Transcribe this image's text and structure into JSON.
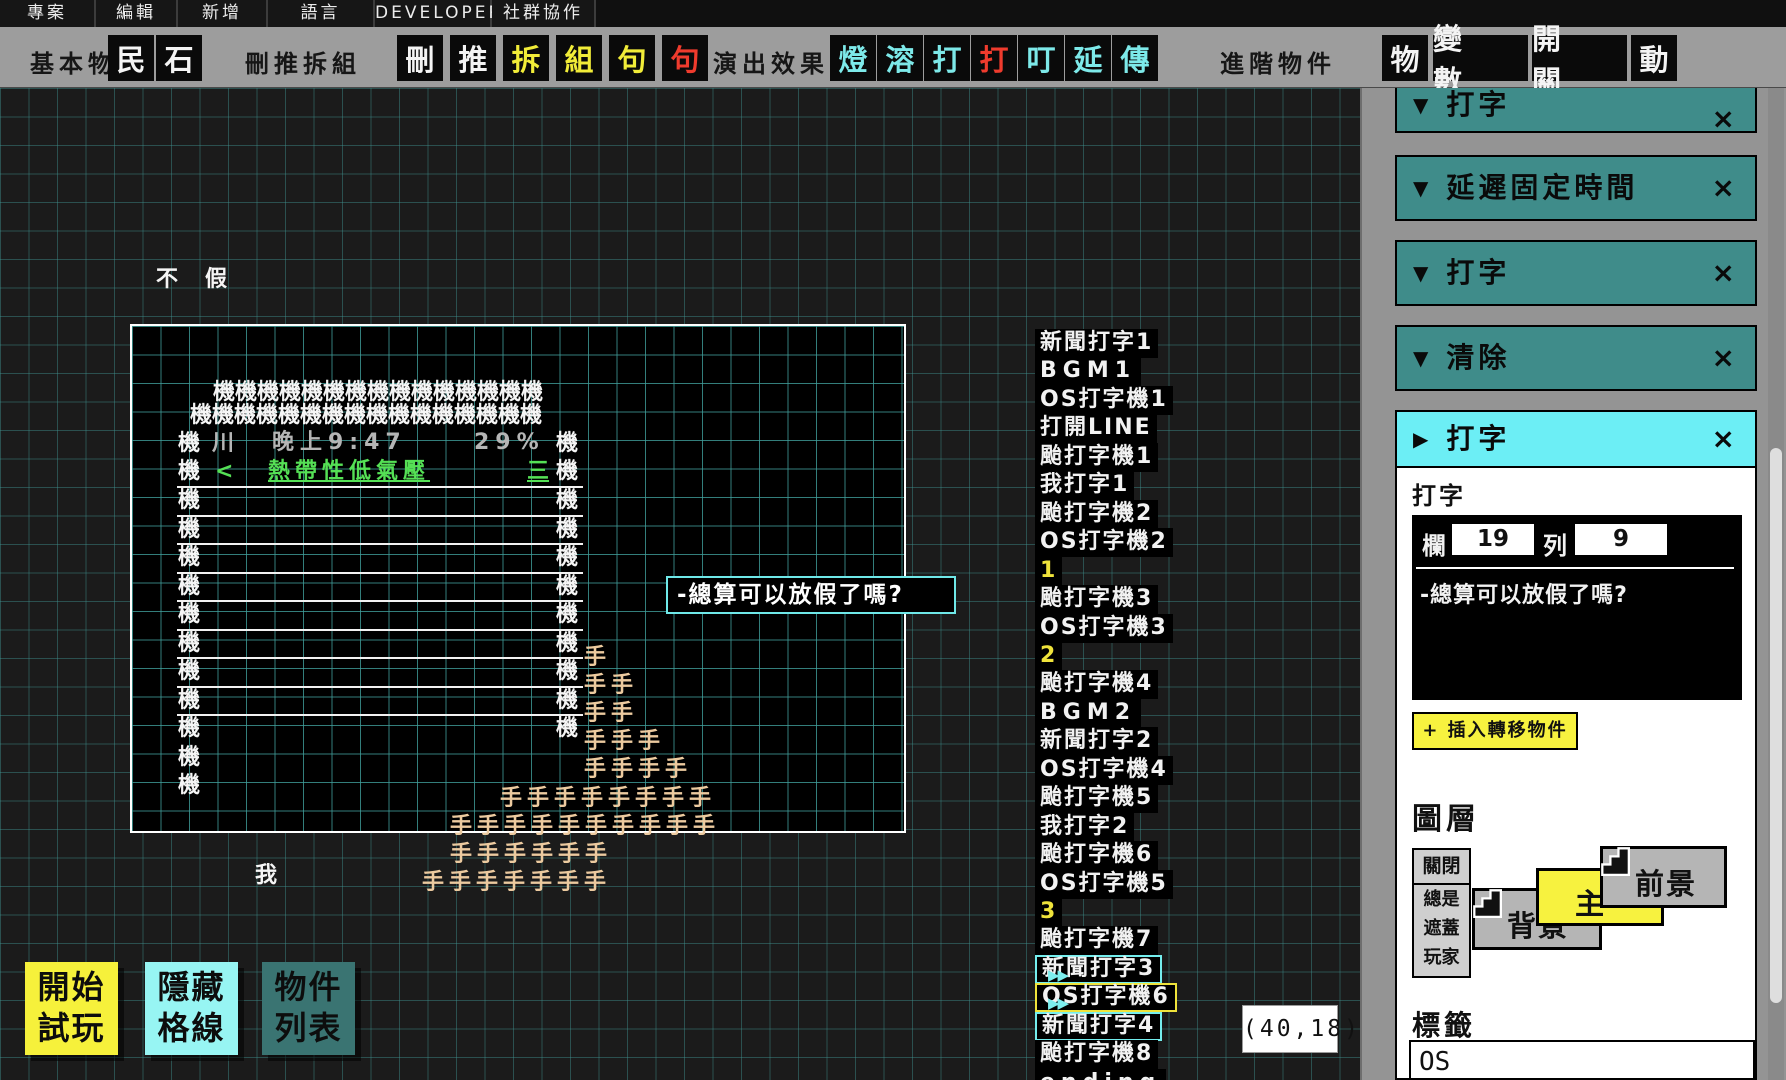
{
  "menu_bar": {
    "items": [
      "專案",
      "編輯",
      "新增",
      "語言",
      "DEVELOPER",
      "社群協作"
    ]
  },
  "toolbar": {
    "groups": [
      {
        "label": "基本物件",
        "buttons": [
          {
            "glyph": "民",
            "color": "white"
          },
          {
            "glyph": "石",
            "color": "white"
          }
        ]
      },
      {
        "label": "刪推拆組",
        "buttons": [
          {
            "glyph": "刪",
            "color": "white"
          },
          {
            "glyph": "推",
            "color": "white"
          },
          {
            "glyph": "拆",
            "color": "yellow"
          },
          {
            "glyph": "組",
            "color": "yellow"
          },
          {
            "glyph": "句",
            "color": "yellow"
          },
          {
            "glyph": "句",
            "color": "red"
          }
        ]
      },
      {
        "label": "演出效果",
        "buttons": [
          {
            "glyph": "燈",
            "color": "cyan"
          },
          {
            "glyph": "溶",
            "color": "cyan"
          },
          {
            "glyph": "打",
            "color": "cyan"
          },
          {
            "glyph": "打",
            "color": "red"
          },
          {
            "glyph": "叮",
            "color": "cyan"
          },
          {
            "glyph": "延",
            "color": "cyan"
          },
          {
            "glyph": "傳",
            "color": "cyan"
          }
        ]
      },
      {
        "label": "進階物件",
        "buttons": [
          {
            "glyph": "物",
            "color": "white"
          },
          {
            "glyph": "變 數",
            "color": "white",
            "wide": true
          },
          {
            "glyph": "開 關",
            "color": "white",
            "wide": true
          },
          {
            "glyph": "動",
            "color": "white"
          }
        ]
      }
    ]
  },
  "canvas": {
    "floating_chars": [
      {
        "x": 156,
        "y": 266,
        "t": "不",
        "c": "w"
      },
      {
        "x": 205,
        "y": 266,
        "t": "假",
        "c": "w"
      },
      {
        "x": 213,
        "y": 379,
        "t": "機機機機機機機機機機機機機機機",
        "c": "w"
      },
      {
        "x": 190,
        "y": 402,
        "t": "機機機機機機機機機機機機機機機機",
        "c": "w"
      },
      {
        "x": 178,
        "y": 430,
        "t": "機",
        "c": "w"
      },
      {
        "x": 212,
        "y": 430,
        "t": "川",
        "c": "g"
      },
      {
        "x": 272,
        "y": 429,
        "t": "晚上9:47",
        "c": "g",
        "ls": 6
      },
      {
        "x": 474,
        "y": 429,
        "t": "29%",
        "c": "g",
        "ls": 6
      },
      {
        "x": 556,
        "y": 430,
        "t": "機",
        "c": "w"
      },
      {
        "x": 178,
        "y": 458,
        "t": "機",
        "c": "w"
      },
      {
        "x": 215,
        "y": 458,
        "t": "<",
        "c": "grn"
      },
      {
        "x": 268,
        "y": 458,
        "t": "熱帶性低氣壓",
        "c": "grn",
        "u": true,
        "ls": 5
      },
      {
        "x": 527,
        "y": 458,
        "t": "三",
        "c": "grn",
        "u": true
      },
      {
        "x": 556,
        "y": 458,
        "t": "機",
        "c": "w"
      },
      {
        "x": 178,
        "y": 487,
        "t": "機\n機\n機\n機\n機\n機\n機\n機\n機\n機\n機",
        "c": "w"
      },
      {
        "x": 556,
        "y": 487,
        "t": "機\n機\n機\n機\n機\n機\n機\n機\n機",
        "c": "w"
      },
      {
        "x": 584,
        "y": 644,
        "t": "手",
        "c": "tan"
      },
      {
        "x": 584,
        "y": 672,
        "t": "手手",
        "c": "tan",
        "ls": 5
      },
      {
        "x": 584,
        "y": 700,
        "t": "手手",
        "c": "tan",
        "ls": 5
      },
      {
        "x": 584,
        "y": 728,
        "t": "手手手",
        "c": "tan",
        "ls": 5
      },
      {
        "x": 584,
        "y": 756,
        "t": "手手手手",
        "c": "tan",
        "ls": 5
      },
      {
        "x": 500,
        "y": 785,
        "t": "手手手手手手手手",
        "c": "tan",
        "ls": 5
      },
      {
        "x": 450,
        "y": 813,
        "t": "手手手手手手手手手手",
        "c": "tan",
        "ls": 5
      },
      {
        "x": 450,
        "y": 841,
        "t": "手手手手手手",
        "c": "tan",
        "ls": 5
      },
      {
        "x": 422,
        "y": 869,
        "t": "手手手手手手手",
        "c": "tan",
        "ls": 5
      },
      {
        "x": 255,
        "y": 862,
        "t": "我",
        "c": "w"
      }
    ],
    "separator_lines": {
      "x": 177,
      "width": 406,
      "ys": [
        486,
        515,
        543,
        572,
        600,
        629,
        657,
        686,
        714
      ]
    },
    "speech_box": {
      "text": "-總算可以放假了嗎?"
    },
    "object_list": [
      {
        "text": "新聞打字1"
      },
      {
        "text": "BGM1",
        "latin": true
      },
      {
        "text": "OS打字機1"
      },
      {
        "text": "打開LINE"
      },
      {
        "text": "颱打字機1"
      },
      {
        "text": "我打字1"
      },
      {
        "text": "颱打字機2"
      },
      {
        "text": "OS打字機2"
      },
      {
        "text": "1",
        "color": "yellow"
      },
      {
        "text": "颱打字機3"
      },
      {
        "text": "OS打字機3"
      },
      {
        "text": "2",
        "color": "yellow"
      },
      {
        "text": "颱打字機4"
      },
      {
        "text": "BGM2",
        "latin": true
      },
      {
        "text": "新聞打字2"
      },
      {
        "text": "OS打字機4"
      },
      {
        "text": "颱打字機5"
      },
      {
        "text": "我打字2"
      },
      {
        "text": "颱打字機6"
      },
      {
        "text": "OS打字機5"
      },
      {
        "text": "3",
        "color": "yellow"
      },
      {
        "text": "颱打字機7"
      },
      {
        "text": "新聞打字3",
        "border": "cyan"
      },
      {
        "text": "OS打字機6",
        "border": "yellow"
      },
      {
        "text": "新聞打字4",
        "border": "cyan"
      },
      {
        "text": "颱打字機8"
      },
      {
        "text": "ending",
        "latin": true
      }
    ],
    "link_arrow_glyph": "▶▶",
    "coords_tooltip": "(40,18)",
    "action_buttons": [
      {
        "label": "開始\n試玩",
        "bg": "#f6f13b"
      },
      {
        "label": "隱藏\n格線",
        "bg": "#97f5f3"
      },
      {
        "label": "物件\n列表",
        "bg": "#3a7472"
      }
    ]
  },
  "sidebar": {
    "collapse_glyph": "▼",
    "expand_glyph": "▶",
    "close_glyph": "×",
    "collapsed_panels": [
      {
        "title": "打字",
        "cut": true
      },
      {
        "title": "延遲固定時間"
      },
      {
        "title": "打字"
      },
      {
        "title": "清除"
      }
    ],
    "active_panel": {
      "title": "打字"
    },
    "typing": {
      "section_label": "打字",
      "column_label": "欄",
      "column_value": "19",
      "row_label": "列",
      "row_value": "9",
      "preview_text": "-總算可以放假了嗎?",
      "insert_button_label": "+ 插入轉移物件"
    },
    "layers": {
      "heading": "圖層",
      "visibility_button": "關閉",
      "cover_button_lines": [
        "總是",
        "遮蓋",
        "玩家"
      ],
      "cards": [
        {
          "label": "背景",
          "type": "gray"
        },
        {
          "label": "主",
          "type": "yellow"
        },
        {
          "label": "前景",
          "type": "gray"
        }
      ]
    },
    "label_field": {
      "heading": "標籤",
      "value": "OS"
    }
  },
  "colors": {
    "accent_yellow": "#f7f23f",
    "accent_cyan": "#6ceef5",
    "panel_teal": "#3f8c8a",
    "grid_teal": "#3e918e",
    "glyph_red": "#ef3b2d",
    "hand_tan": "#ecca9f",
    "link_green": "#55e055"
  }
}
